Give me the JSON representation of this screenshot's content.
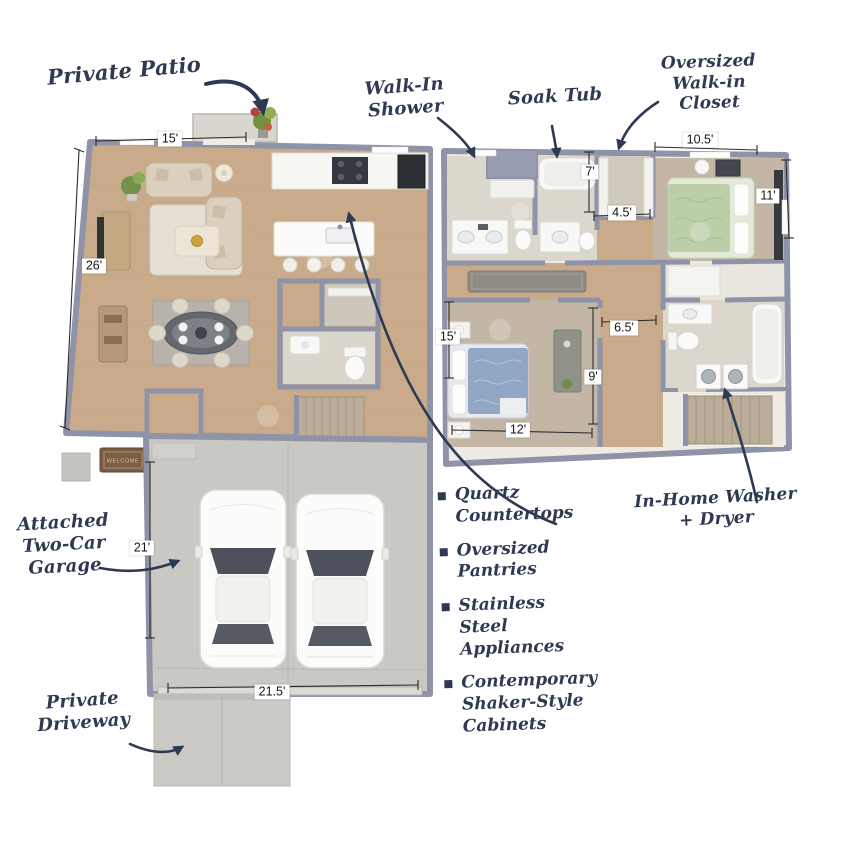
{
  "annotations": {
    "private_patio": "Private Patio",
    "walk_in_shower": "Walk-In Shower",
    "soak_tub": "Soak Tub",
    "oversized_closet": "Oversized Walk-in Closet",
    "attached_garage": "Attached Two-Car Garage",
    "private_driveway": "Private Driveway",
    "in_home_laundry": "In-Home Washer + Dryer"
  },
  "features": {
    "items": [
      "Quartz Countertops",
      "Oversized Pantries",
      "Stainless Steel Appliances",
      "Contemporary Shaker-Style Cabinets"
    ]
  },
  "dimensions": {
    "living_width_top": "15'",
    "living_depth": "26'",
    "wic_depth": "7'",
    "wic_width": "4.5'",
    "bedroom1_width": "10.5'",
    "bedroom1_depth": "11'",
    "bedroom2_depth": "15'",
    "hall_width": "6.5'",
    "hall_depth": "9'",
    "bedroom2_width": "12'",
    "garage_depth": "21'",
    "garage_width": "21.5'"
  },
  "doormat": {
    "text": "WELCOME"
  },
  "colors": {
    "annotation_navy": "#2e3a52",
    "wall_slate": "#8e93a7",
    "wood_floor": "#c9ab8b",
    "carpet": "#c3b6a5",
    "bath_tile": "#dcd7cd",
    "concrete": "#c9c8c3",
    "driveway": "#cccac5",
    "bed_green": "#bccfa8",
    "bed_blue": "#92a6c6"
  }
}
